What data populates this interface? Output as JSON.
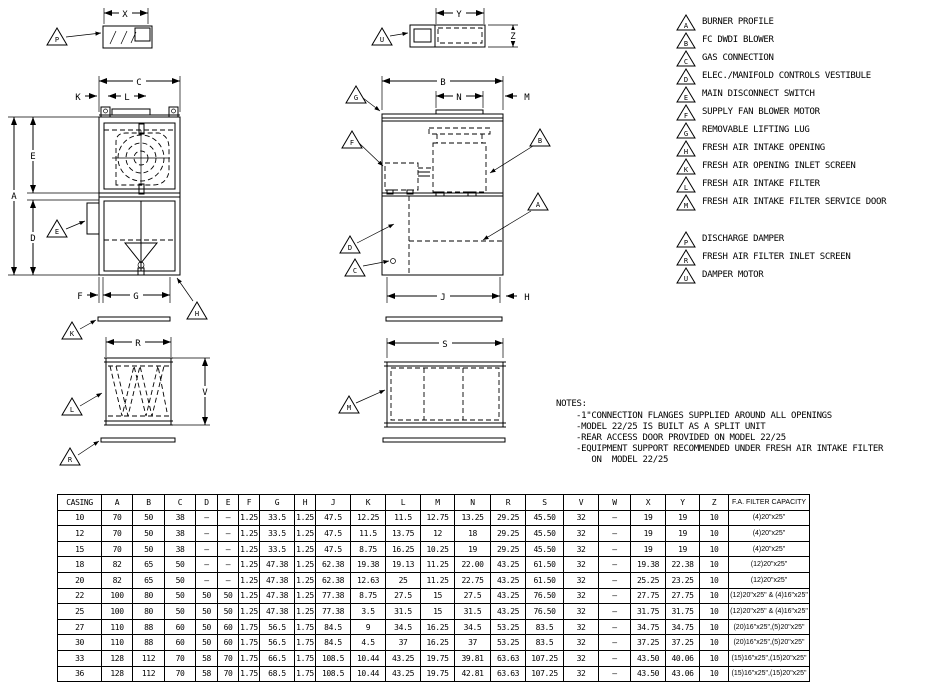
{
  "colors": {
    "ink": "#000000",
    "paper": "#ffffff"
  },
  "letters": {
    "A": "A",
    "B": "B",
    "C": "C",
    "D": "D",
    "E": "E",
    "F": "F",
    "G": "G",
    "H": "H",
    "J": "J",
    "K": "K",
    "L": "L",
    "M": "M",
    "N": "N",
    "P": "P",
    "R": "R",
    "S": "S",
    "U": "U",
    "V": "V",
    "W": "W",
    "X": "X",
    "Y": "Y",
    "Z": "Z"
  },
  "legend": {
    "groups": [
      [
        {
          "tag": "A",
          "label": "BURNER PROFILE"
        },
        {
          "tag": "B",
          "label": "FC DWDI BLOWER"
        },
        {
          "tag": "C",
          "label": "GAS CONNECTION"
        },
        {
          "tag": "D",
          "label": "ELEC./MANIFOLD CONTROLS VESTIBULE"
        },
        {
          "tag": "E",
          "label": "MAIN DISCONNECT SWITCH"
        },
        {
          "tag": "F",
          "label": "SUPPLY FAN BLOWER MOTOR"
        },
        {
          "tag": "G",
          "label": "REMOVABLE LIFTING LUG"
        },
        {
          "tag": "H",
          "label": "FRESH AIR INTAKE OPENING"
        },
        {
          "tag": "K",
          "label": "FRESH AIR OPENING INLET SCREEN"
        },
        {
          "tag": "L",
          "label": "FRESH AIR INTAKE FILTER"
        },
        {
          "tag": "M",
          "label": "FRESH AIR INTAKE FILTER SERVICE DOOR"
        }
      ],
      [
        {
          "tag": "P",
          "label": "DISCHARGE DAMPER"
        },
        {
          "tag": "R",
          "label": "FRESH AIR FILTER INLET SCREEN"
        },
        {
          "tag": "U",
          "label": "DAMPER MOTOR"
        }
      ]
    ]
  },
  "notes": {
    "title": "NOTES:",
    "lines": [
      "-1\"CONNECTION FLANGES SUPPLIED AROUND ALL OPENINGS",
      "-MODEL 22/25 IS BUILT AS A SPLIT UNIT",
      "-REAR ACCESS DOOR PROVIDED ON MODEL 22/25",
      "-EQUIPMENT SUPPORT RECOMMENDED UNDER FRESH AIR INTAKE FILTER",
      "   ON  MODEL 22/25"
    ]
  },
  "table": {
    "columns": [
      "CASING",
      "A",
      "B",
      "C",
      "D",
      "E",
      "F",
      "G",
      "H",
      "J",
      "K",
      "L",
      "M",
      "N",
      "R",
      "S",
      "V",
      "W",
      "X",
      "Y",
      "Z",
      "F.A. FILTER CAPACITY"
    ],
    "col_widths": [
      44,
      31,
      32,
      31,
      22,
      21,
      21,
      35,
      21,
      35,
      35,
      35,
      34,
      36,
      35,
      38,
      35,
      32,
      35,
      34,
      29,
      81
    ],
    "rows": [
      [
        "10",
        "70",
        "50",
        "38",
        "–",
        "–",
        "1.25",
        "33.5",
        "1.25",
        "47.5",
        "12.25",
        "11.5",
        "12.75",
        "13.25",
        "29.25",
        "45.50",
        "32",
        "–",
        "19",
        "19",
        "10",
        "(4)20\"x25\""
      ],
      [
        "12",
        "70",
        "50",
        "38",
        "–",
        "–",
        "1.25",
        "33.5",
        "1.25",
        "47.5",
        "11.5",
        "13.75",
        "12",
        "18",
        "29.25",
        "45.50",
        "32",
        "–",
        "19",
        "19",
        "10",
        "(4)20\"x25\""
      ],
      [
        "15",
        "70",
        "50",
        "38",
        "–",
        "–",
        "1.25",
        "33.5",
        "1.25",
        "47.5",
        "8.75",
        "16.25",
        "10.25",
        "19",
        "29.25",
        "45.50",
        "32",
        "–",
        "19",
        "19",
        "10",
        "(4)20\"x25\""
      ],
      [
        "18",
        "82",
        "65",
        "50",
        "–",
        "–",
        "1.25",
        "47.38",
        "1.25",
        "62.38",
        "19.38",
        "19.13",
        "11.25",
        "22.00",
        "43.25",
        "61.50",
        "32",
        "–",
        "19.38",
        "22.38",
        "10",
        "(12)20\"x25\""
      ],
      [
        "20",
        "82",
        "65",
        "50",
        "–",
        "–",
        "1.25",
        "47.38",
        "1.25",
        "62.38",
        "12.63",
        "25",
        "11.25",
        "22.75",
        "43.25",
        "61.50",
        "32",
        "–",
        "25.25",
        "23.25",
        "10",
        "(12)20\"x25\""
      ],
      [
        "22",
        "100",
        "80",
        "50",
        "50",
        "50",
        "1.25",
        "47.38",
        "1.25",
        "77.38",
        "8.75",
        "27.5",
        "15",
        "27.5",
        "43.25",
        "76.50",
        "32",
        "–",
        "27.75",
        "27.75",
        "10",
        "(12)20\"x25\" & (4)16\"x25\""
      ],
      [
        "25",
        "100",
        "80",
        "50",
        "50",
        "50",
        "1.25",
        "47.38",
        "1.25",
        "77.38",
        "3.5",
        "31.5",
        "15",
        "31.5",
        "43.25",
        "76.50",
        "32",
        "–",
        "31.75",
        "31.75",
        "10",
        "(12)20\"x25\" & (4)16\"x25\""
      ],
      [
        "27",
        "110",
        "88",
        "60",
        "50",
        "60",
        "1.75",
        "56.5",
        "1.75",
        "84.5",
        "9",
        "34.5",
        "16.25",
        "34.5",
        "53.25",
        "83.5",
        "32",
        "–",
        "34.75",
        "34.75",
        "10",
        "(20)16\"x25\",(5)20\"x25\""
      ],
      [
        "30",
        "110",
        "88",
        "60",
        "50",
        "60",
        "1.75",
        "56.5",
        "1.75",
        "84.5",
        "4.5",
        "37",
        "16.25",
        "37",
        "53.25",
        "83.5",
        "32",
        "–",
        "37.25",
        "37.25",
        "10",
        "(20)16\"x25\",(5)20\"x25\""
      ],
      [
        "33",
        "128",
        "112",
        "70",
        "58",
        "70",
        "1.75",
        "66.5",
        "1.75",
        "108.5",
        "10.44",
        "43.25",
        "19.75",
        "39.81",
        "63.63",
        "107.25",
        "32",
        "–",
        "43.50",
        "40.06",
        "10",
        "(15)16\"x25\",(15)20\"x25\""
      ],
      [
        "36",
        "128",
        "112",
        "70",
        "58",
        "70",
        "1.75",
        "68.5",
        "1.75",
        "108.5",
        "10.44",
        "43.25",
        "19.75",
        "42.81",
        "63.63",
        "107.25",
        "32",
        "–",
        "43.50",
        "43.06",
        "10",
        "(15)16\"x25\",(15)20\"x25\""
      ]
    ]
  }
}
